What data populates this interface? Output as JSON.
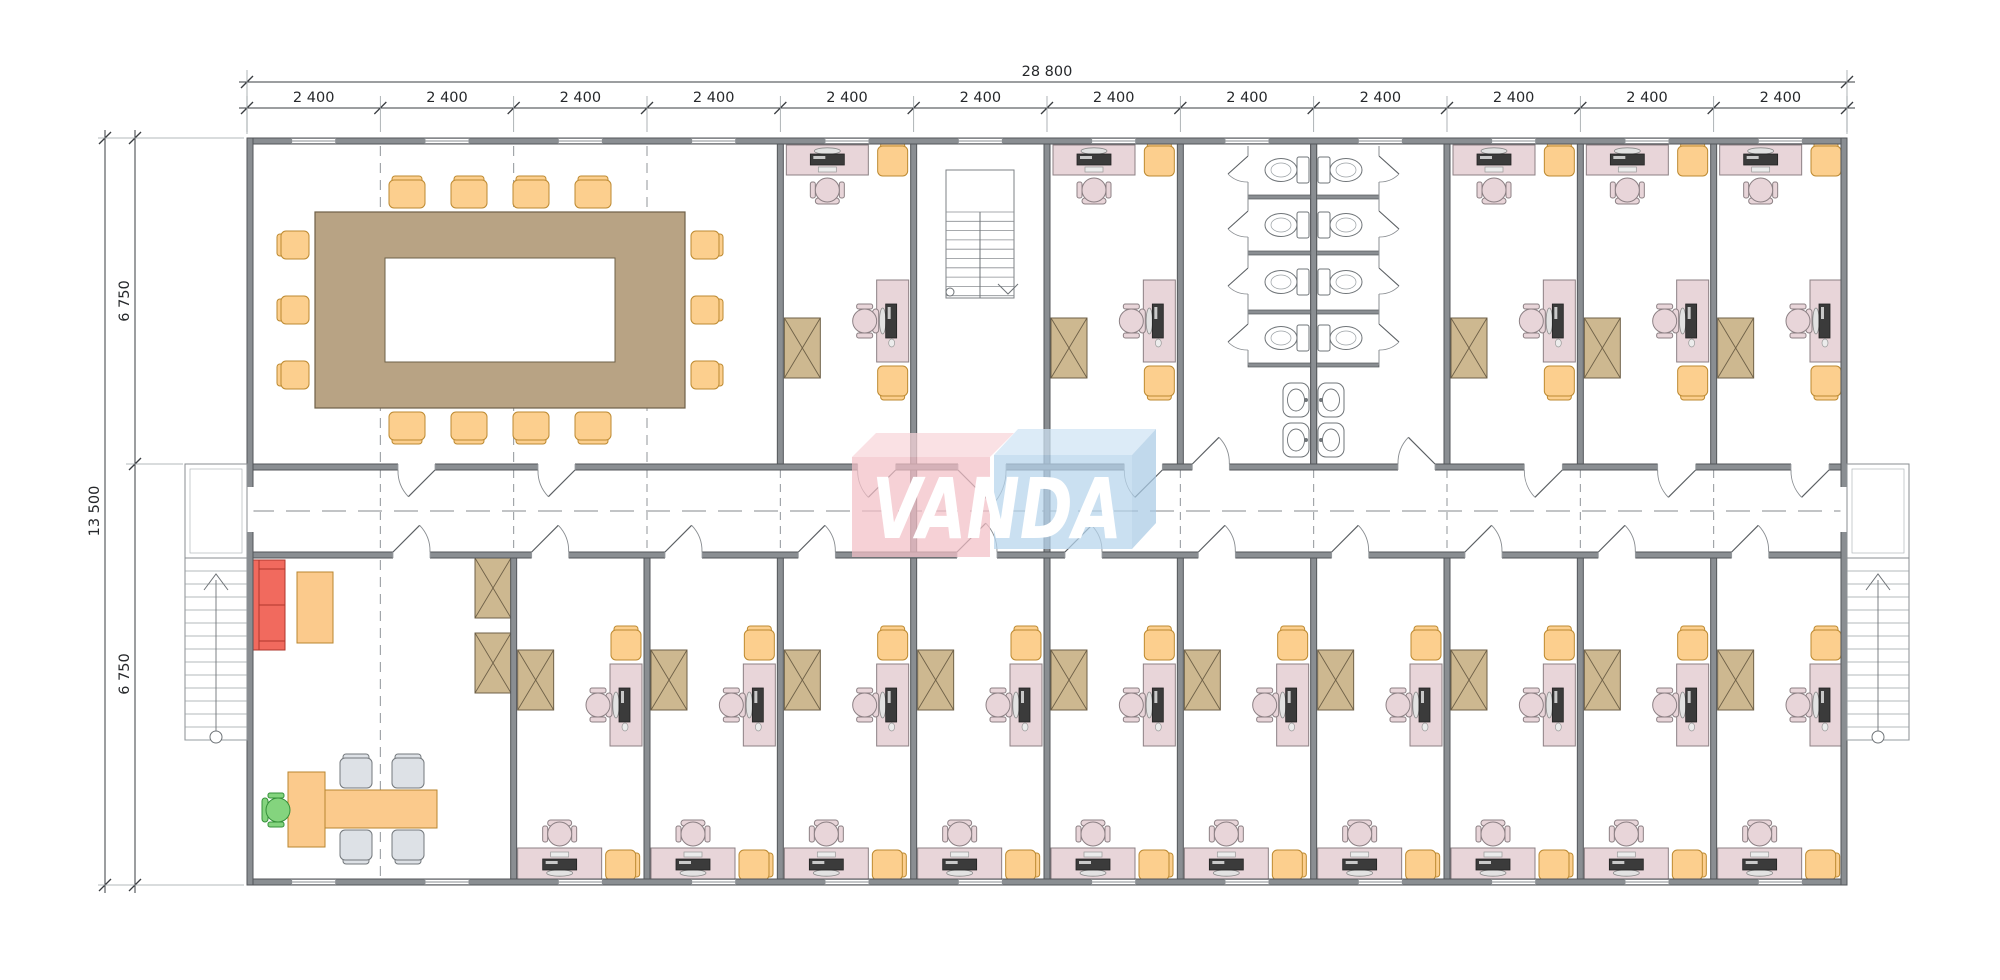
{
  "type": "architectural-floor-plan",
  "logo": {
    "text": "VANDA",
    "pink": "#f3bfc6",
    "pink_top": "#f8d6da",
    "blue": "#b5d4ec",
    "blue_top": "#cfe3f4",
    "blue_side": "#a9cae5",
    "text_color": "#ffffff"
  },
  "dimensions": {
    "horizontal": {
      "total": "28 800",
      "modules": [
        "2 400",
        "2 400",
        "2 400",
        "2 400",
        "2 400",
        "2 400",
        "2 400",
        "2 400",
        "2 400",
        "2 400",
        "2 400",
        "2 400"
      ]
    },
    "vertical": {
      "total": "13 500",
      "segments": [
        "6 750",
        "6 750"
      ]
    }
  },
  "colors": {
    "wall": "#8a8e92",
    "wallEdge": "#53565a",
    "thinLine": "#85898d",
    "dash": "#90959a",
    "dim": "#3a3d41",
    "dimExt": "#9aa0a4",
    "desk": "#e8d5d9",
    "deskEdge": "#8c8084",
    "chairOrange": "#fccf8e",
    "chairOrangeEdge": "#bd8a31",
    "tableTan": "#b8a384",
    "tableTanEdge": "#6e6048",
    "cabinet": "#cdb890",
    "cabinetEdge": "#6f6148",
    "sofa": "#f16a5e",
    "sofaEdge": "#ae372c",
    "orangeTable": "#fbca8c",
    "orangeTableEdge": "#b8862f",
    "guestChair": "#dde1e6",
    "guestChairEdge": "#73787c",
    "greenChair": "#84d47e",
    "greenChairEdge": "#35903a",
    "fixture": "#ffffff",
    "fixtureEdge": "#6f7478",
    "monitor": "#3b3b3b"
  },
  "rooms": {
    "top": [
      {
        "name": "conference-room",
        "modules": [
          0,
          4
        ],
        "furniture": {
          "conference_table": 1,
          "chairs": 14
        }
      },
      {
        "name": "office",
        "modules": [
          4,
          5
        ]
      },
      {
        "name": "stairwell",
        "modules": [
          5,
          6
        ],
        "furniture": {
          "staircase": 1
        }
      },
      {
        "name": "office",
        "modules": [
          6,
          7
        ]
      },
      {
        "name": "wc",
        "modules": [
          7,
          9
        ],
        "furniture": {
          "toilets": 8,
          "wash_basins": 4,
          "stalls": 8
        }
      },
      {
        "name": "office",
        "modules": [
          9,
          10
        ]
      },
      {
        "name": "office",
        "modules": [
          10,
          11
        ]
      },
      {
        "name": "office",
        "modules": [
          11,
          12
        ]
      }
    ],
    "bottom": [
      {
        "name": "reception-lounge",
        "modules": [
          0,
          2
        ],
        "furniture": {
          "sofa": 1,
          "coffee_table": 1,
          "reception_desk": 1,
          "meeting_table": 1,
          "guest_chairs": 4,
          "task_chair": 1,
          "cabinets": 2
        }
      },
      {
        "name": "office",
        "modules": [
          2,
          3
        ]
      },
      {
        "name": "office",
        "modules": [
          3,
          4
        ]
      },
      {
        "name": "office",
        "modules": [
          4,
          5
        ]
      },
      {
        "name": "office",
        "modules": [
          5,
          6
        ]
      },
      {
        "name": "office",
        "modules": [
          6,
          7
        ]
      },
      {
        "name": "office",
        "modules": [
          7,
          8
        ]
      },
      {
        "name": "office",
        "modules": [
          8,
          9
        ]
      },
      {
        "name": "office",
        "modules": [
          9,
          10
        ]
      },
      {
        "name": "office",
        "modules": [
          10,
          11
        ]
      },
      {
        "name": "office",
        "modules": [
          11,
          12
        ]
      }
    ],
    "office_furniture": {
      "desks": 2,
      "task_chairs": 2,
      "visitor_chairs": 2,
      "cabinet": 1,
      "monitors": 2
    },
    "corridor": {
      "name": "corridor"
    },
    "exterior": {
      "entrance_stairs": 2,
      "landings": 2
    }
  }
}
